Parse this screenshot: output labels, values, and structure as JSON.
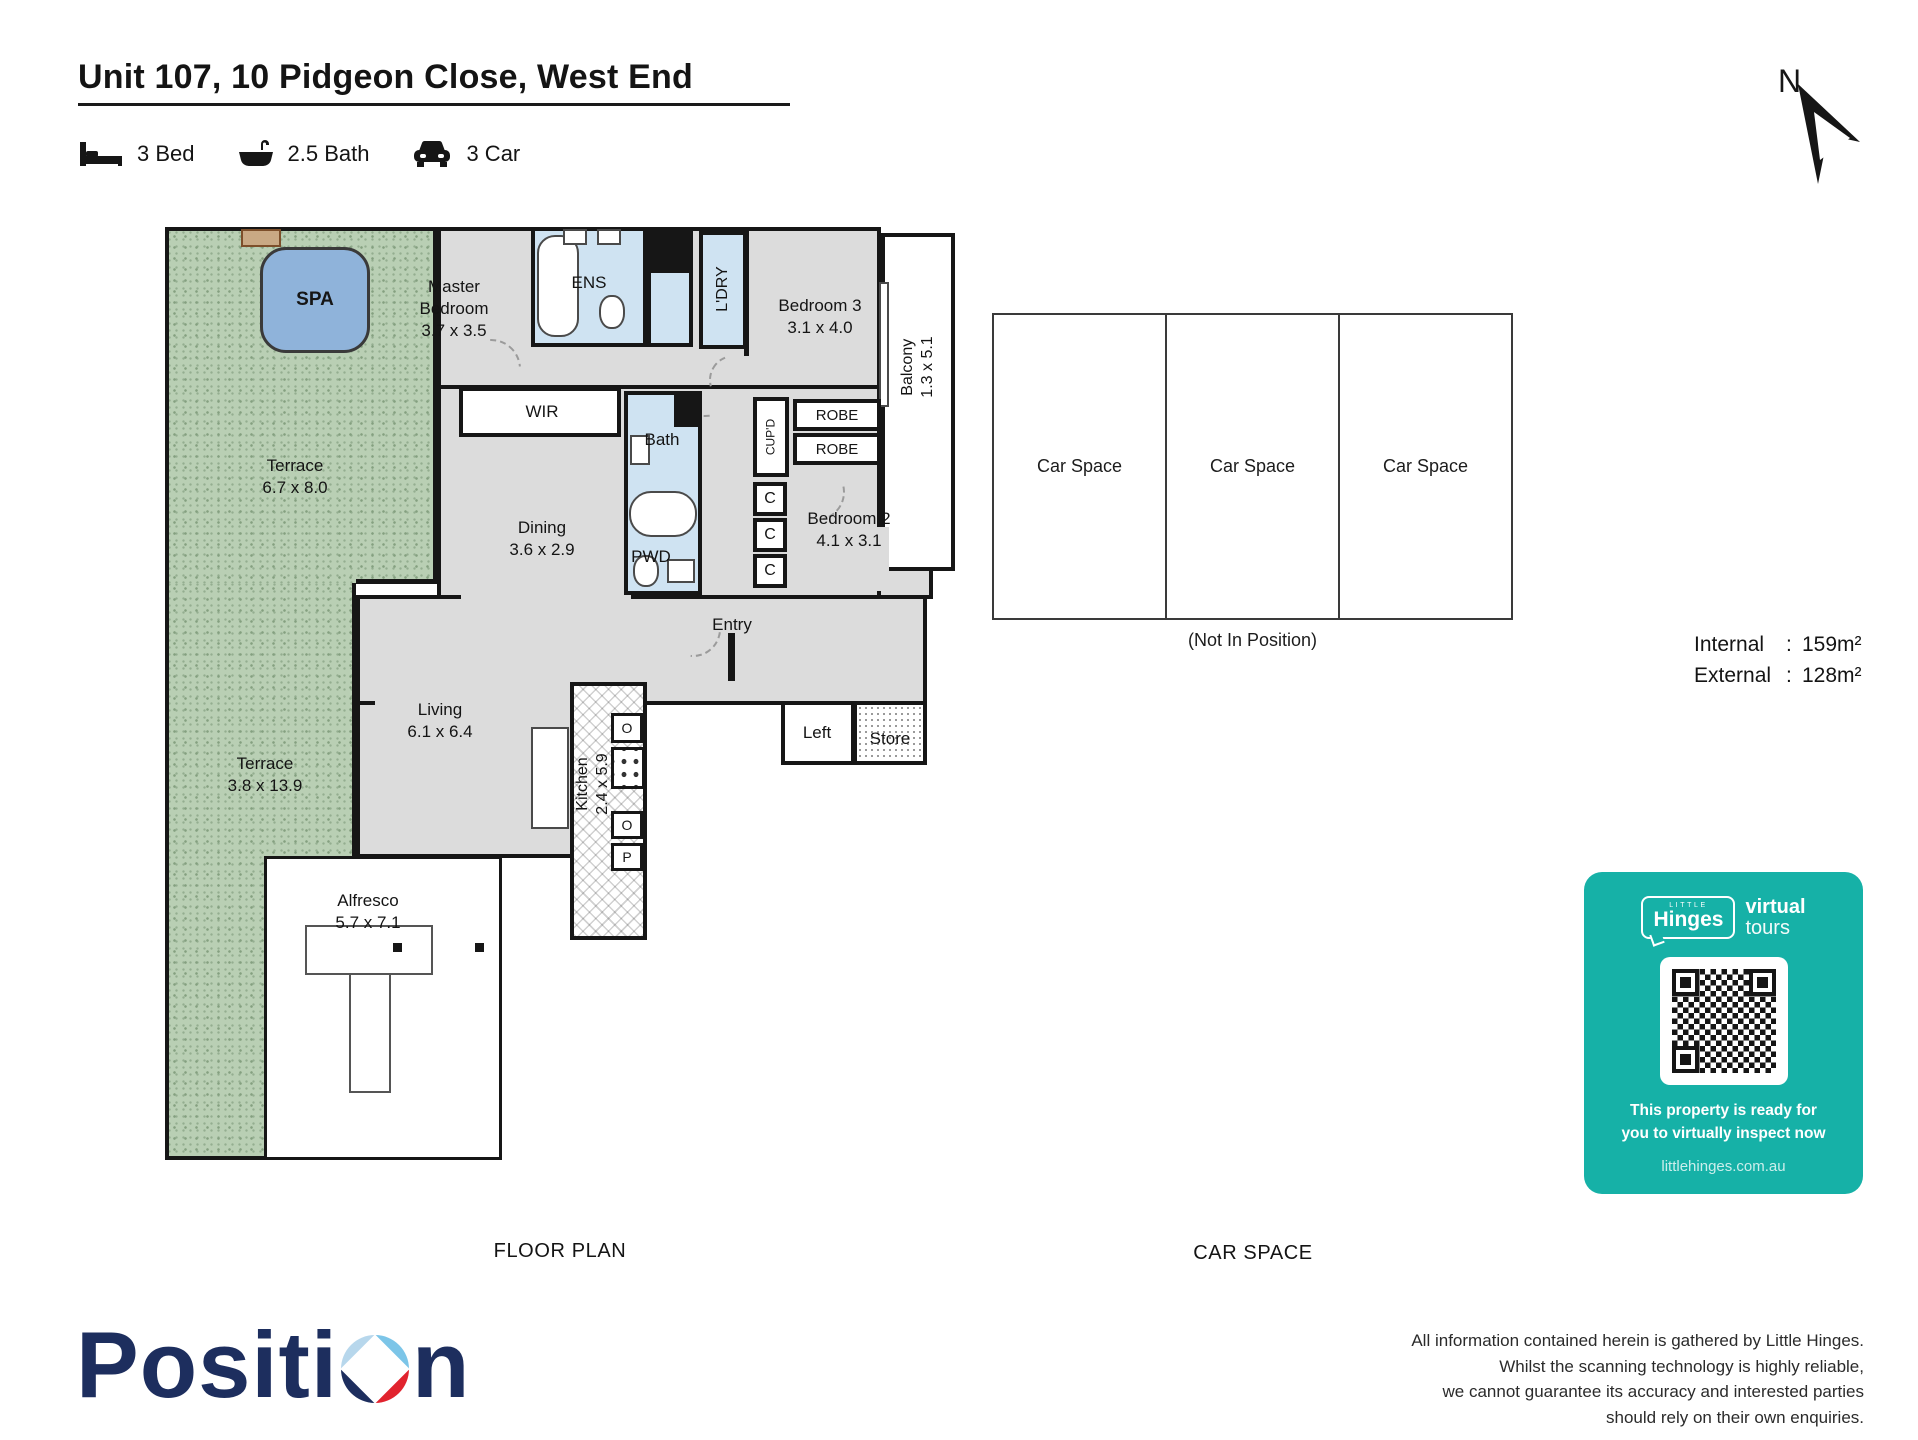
{
  "header": {
    "title": "Unit 107, 10 Pidgeon Close, West End",
    "features": [
      {
        "icon": "bed-icon",
        "label": "3 Bed"
      },
      {
        "icon": "bath-icon",
        "label": "2.5 Bath"
      },
      {
        "icon": "car-icon",
        "label": "3 Car"
      }
    ],
    "compass_label": "N"
  },
  "floor_plan": {
    "rooms": {
      "spa": {
        "label": "SPA"
      },
      "master": {
        "label": "Master Bedroom",
        "dims": "3.7 x 3.5"
      },
      "ens": {
        "label": "ENS"
      },
      "ldry": {
        "label": "L'DRY"
      },
      "bedroom3": {
        "label": "Bedroom 3",
        "dims": "3.1 x 4.0"
      },
      "balcony": {
        "label": "Balcony",
        "dims": "1.3 x 5.1"
      },
      "wir": {
        "label": "WIR"
      },
      "bath": {
        "label": "Bath"
      },
      "cupd": {
        "label": "CUP'D"
      },
      "robe_top": {
        "label": "ROBE"
      },
      "robe_bottom": {
        "label": "ROBE"
      },
      "terrace_upper": {
        "label": "Terrace",
        "dims": "6.7 x 8.0"
      },
      "dining": {
        "label": "Dining",
        "dims": "3.6 x 2.9"
      },
      "pwd": {
        "label": "PWD"
      },
      "closet1": {
        "label": "C"
      },
      "closet2": {
        "label": "C"
      },
      "closet3": {
        "label": "C"
      },
      "bedroom2": {
        "label": "Bedroom 2",
        "dims": "4.1 x 3.1"
      },
      "entry": {
        "label": "Entry"
      },
      "living": {
        "label": "Living",
        "dims": "6.1 x 6.4"
      },
      "kitchen": {
        "label": "Kitchen",
        "dims": "2.4 x 5.9"
      },
      "left_room": {
        "label": "Left"
      },
      "store": {
        "label": "Store"
      },
      "terrace_lower": {
        "label": "Terrace",
        "dims": "3.8 x 13.9"
      },
      "alfresco": {
        "label": "Alfresco",
        "dims": "5.7 x 7.1"
      }
    },
    "appliance_labels": {
      "oven_top": "O",
      "oven_bottom": "O",
      "pantry": "P"
    }
  },
  "car_space": {
    "units": [
      "Car Space",
      "Car Space",
      "Car Space"
    ],
    "note": "(Not In Position)"
  },
  "areas": {
    "rows": [
      {
        "label": "Internal",
        "colon": ":",
        "value": "159m²"
      },
      {
        "label": "External",
        "colon": ":",
        "value": "128m²"
      }
    ]
  },
  "section_labels": {
    "floor_plan": "FLOOR PLAN",
    "car_space": "CAR SPACE"
  },
  "virtual_tour_card": {
    "brand_small": "LITTLE",
    "brand": "Hinges",
    "product_word1": "virtual",
    "product_word2": "tours",
    "message_line1": "This property is ready for",
    "message_line2": "you to virtually inspect now",
    "website": "littlehinges.com.au",
    "bg_color": "#16b1a7"
  },
  "footer": {
    "logo_text_left": "Positi",
    "logo_text_right": "n",
    "disclaimer_lines": [
      "All information contained herein is gathered by Little Hinges.",
      "Whilst the scanning technology is highly reliable,",
      "we cannot guarantee its accuracy and interested parties",
      "should rely on their own enquiries."
    ]
  },
  "colors": {
    "accent_teal": "#16b1a7",
    "logo_navy": "#1d2e5e",
    "logo_red": "#e1232e",
    "terrace_green": "#b9cfb4",
    "wet_area_blue": "#cfe3f2",
    "spa_blue": "#8fb3da",
    "floor_gray": "#dcdcdc"
  }
}
